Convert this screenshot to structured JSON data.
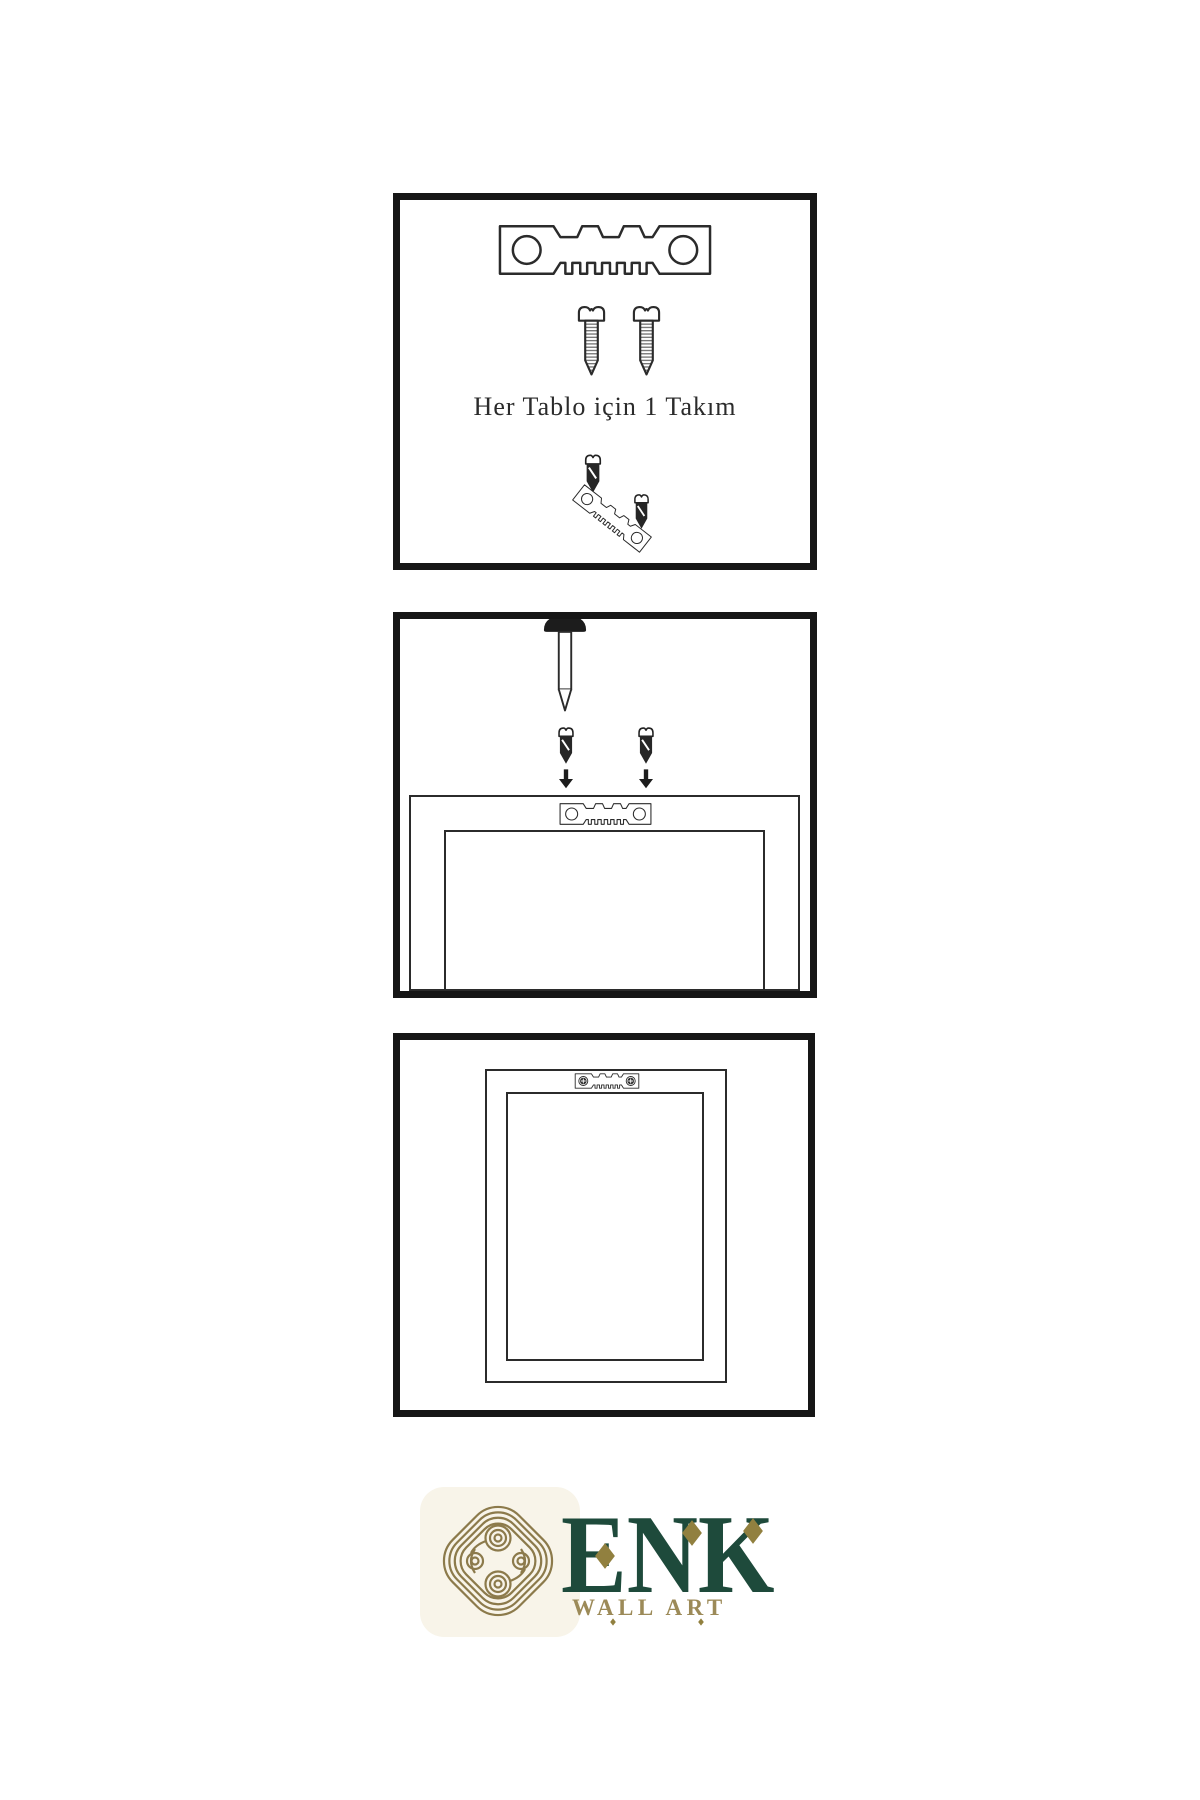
{
  "page": {
    "background_color": "#ffffff",
    "line_color": "#161616"
  },
  "steps": [
    {
      "id": "hardware-kit",
      "caption": "Her Tablo için 1 Takım",
      "items": [
        "sawtooth-hanger",
        "screw",
        "screw",
        "screw-over-angled-hanger",
        "screw"
      ]
    },
    {
      "id": "mount-hanger-on-frame",
      "items": [
        "wall-nail",
        "screw",
        "screw",
        "arrow-down",
        "arrow-down",
        "frame-back",
        "sawtooth-hanger"
      ]
    },
    {
      "id": "frame-hung",
      "items": [
        "frame-back",
        "sawtooth-hanger-with-screws"
      ]
    }
  ],
  "brand": {
    "name": "ENK",
    "subtitle": "WALL ART",
    "logo": "knot-icon",
    "name_color": "#1e4a3b",
    "subtitle_color": "#9c8a58",
    "knot_color": "#8c7a4b",
    "diamond_color": "#91803f"
  }
}
